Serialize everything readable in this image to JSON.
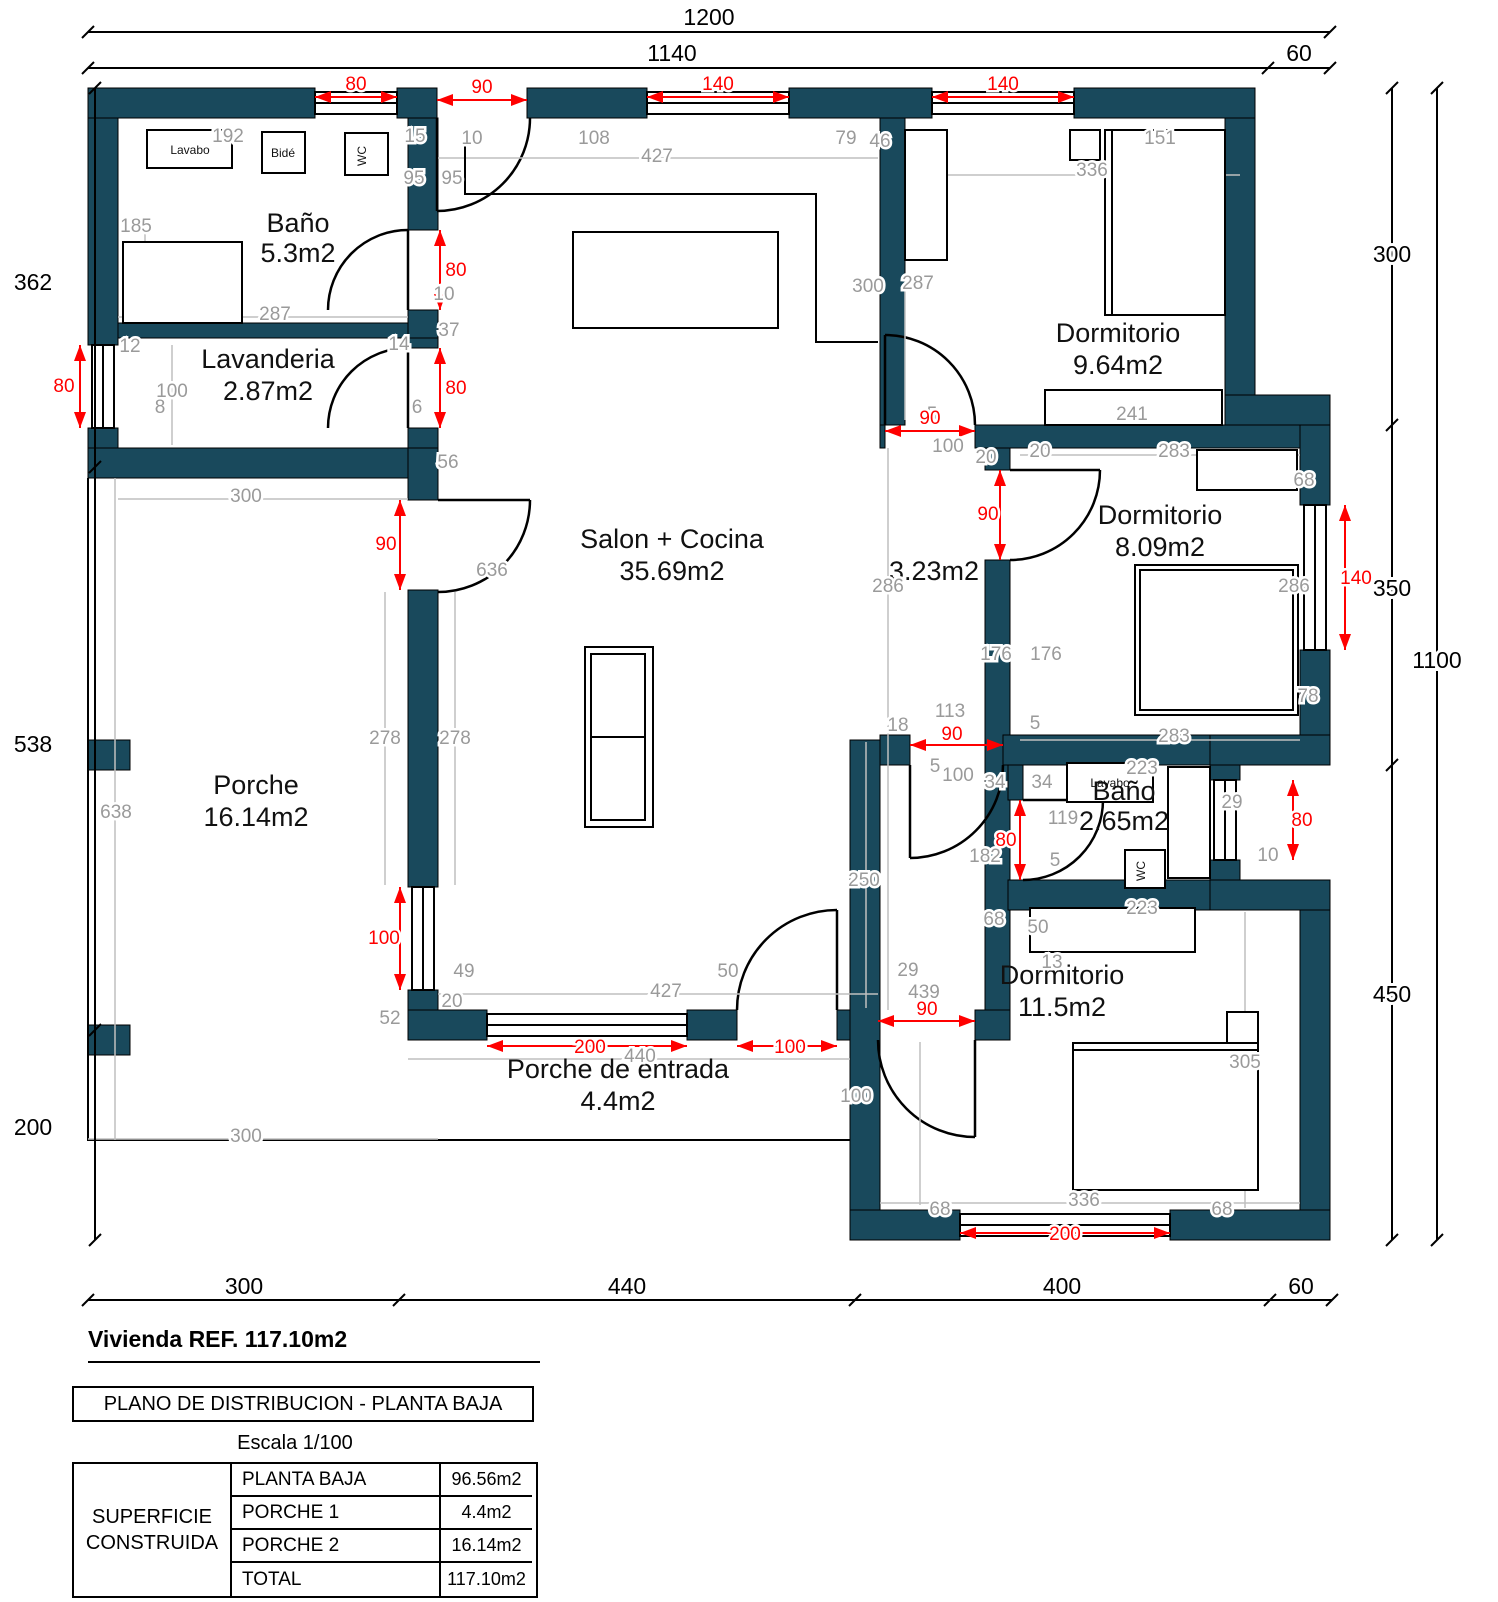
{
  "plan": {
    "colors": {
      "wall": "#19495c",
      "dim_red": "#ff0000",
      "dim_gray": "#9a9a9a",
      "line_gray": "#b5b5b5"
    },
    "room_labels": [
      {
        "n": "room-label-bano1",
        "t": "Baño",
        "x": 298,
        "y": 232
      },
      {
        "n": "room-area-bano1",
        "t": "5.3m2",
        "x": 298,
        "y": 262
      },
      {
        "n": "room-label-lavanderia",
        "t": "Lavanderia",
        "x": 268,
        "y": 368
      },
      {
        "n": "room-area-lavanderia",
        "t": "2.87m2",
        "x": 268,
        "y": 400
      },
      {
        "n": "room-label-salon",
        "t": "Salon + Cocina",
        "x": 672,
        "y": 548
      },
      {
        "n": "room-area-salon",
        "t": "35.69m2",
        "x": 672,
        "y": 580
      },
      {
        "n": "room-label-dormitorio1",
        "t": "Dormitorio",
        "x": 1118,
        "y": 342
      },
      {
        "n": "room-area-dormitorio1",
        "t": "9.64m2",
        "x": 1118,
        "y": 374
      },
      {
        "n": "room-area-pasillo",
        "t": "3.23m2",
        "x": 934,
        "y": 580
      },
      {
        "n": "room-label-dormitorio2",
        "t": "Dormitorio",
        "x": 1160,
        "y": 524
      },
      {
        "n": "room-area-dormitorio2",
        "t": "8.09m2",
        "x": 1160,
        "y": 556
      },
      {
        "n": "room-label-bano2",
        "t": "Baño",
        "x": 1124,
        "y": 800
      },
      {
        "n": "room-area-bano2",
        "t": "2.65m2",
        "x": 1124,
        "y": 830
      },
      {
        "n": "room-label-dormitorio3",
        "t": "Dormitorio",
        "x": 1062,
        "y": 984
      },
      {
        "n": "room-area-dormitorio3",
        "t": "11.5m2",
        "x": 1062,
        "y": 1016
      },
      {
        "n": "room-label-porche",
        "t": "Porche",
        "x": 256,
        "y": 794
      },
      {
        "n": "room-area-porche",
        "t": "16.14m2",
        "x": 256,
        "y": 826
      },
      {
        "n": "room-label-porche-entrada",
        "t": "Porche de entrada",
        "x": 618,
        "y": 1078
      },
      {
        "n": "room-area-porche-entrada",
        "t": "4.4m2",
        "x": 618,
        "y": 1110
      }
    ],
    "dims_black": [
      {
        "t": "1200",
        "x": 709,
        "y": 25
      },
      {
        "t": "1140",
        "x": 672,
        "y": 61
      },
      {
        "t": "60",
        "x": 1299,
        "y": 61
      },
      {
        "t": "300",
        "x": 1392,
        "y": 262
      },
      {
        "t": "350",
        "x": 1392,
        "y": 596
      },
      {
        "t": "450",
        "x": 1392,
        "y": 1002
      },
      {
        "t": "1100",
        "x": 1437,
        "y": 668
      },
      {
        "t": "362",
        "x": 33,
        "y": 290
      },
      {
        "t": "538",
        "x": 33,
        "y": 752
      },
      {
        "t": "200",
        "x": 33,
        "y": 1135
      },
      {
        "t": "300",
        "x": 244,
        "y": 1294
      },
      {
        "t": "440",
        "x": 627,
        "y": 1294
      },
      {
        "t": "400",
        "x": 1062,
        "y": 1294
      },
      {
        "t": "60",
        "x": 1301,
        "y": 1294
      }
    ],
    "dims_red": [
      {
        "t": "80",
        "x": 356,
        "y": 90
      },
      {
        "t": "90",
        "x": 482,
        "y": 93
      },
      {
        "t": "140",
        "x": 718,
        "y": 90
      },
      {
        "t": "140",
        "x": 1003,
        "y": 90
      },
      {
        "t": "80",
        "x": 456,
        "y": 276
      },
      {
        "t": "80",
        "x": 456,
        "y": 394
      },
      {
        "t": "80",
        "x": 64,
        "y": 392
      },
      {
        "t": "90",
        "x": 386,
        "y": 550
      },
      {
        "t": "90",
        "x": 930,
        "y": 424
      },
      {
        "t": "90",
        "x": 988,
        "y": 520
      },
      {
        "t": "140",
        "x": 1356,
        "y": 584
      },
      {
        "t": "90",
        "x": 952,
        "y": 740
      },
      {
        "t": "80",
        "x": 1006,
        "y": 846
      },
      {
        "t": "80",
        "x": 1302,
        "y": 826
      },
      {
        "t": "100",
        "x": 384,
        "y": 944
      },
      {
        "t": "200",
        "x": 590,
        "y": 1053
      },
      {
        "t": "100",
        "x": 790,
        "y": 1053
      },
      {
        "t": "90",
        "x": 927,
        "y": 1015
      },
      {
        "t": "200",
        "x": 1065,
        "y": 1240
      }
    ],
    "dims_gray": [
      {
        "t": "192",
        "x": 228,
        "y": 142
      },
      {
        "t": "15",
        "x": 415,
        "y": 142
      },
      {
        "t": "10",
        "x": 472,
        "y": 144
      },
      {
        "t": "95",
        "x": 414,
        "y": 184
      },
      {
        "t": "95",
        "x": 452,
        "y": 184
      },
      {
        "t": "185",
        "x": 136,
        "y": 232
      },
      {
        "t": "287",
        "x": 275,
        "y": 320
      },
      {
        "t": "10",
        "x": 444,
        "y": 300
      },
      {
        "t": "37",
        "x": 449,
        "y": 336
      },
      {
        "t": "12",
        "x": 130,
        "y": 352
      },
      {
        "t": "14",
        "x": 399,
        "y": 350
      },
      {
        "t": "100",
        "x": 172,
        "y": 397
      },
      {
        "t": "8",
        "x": 160,
        "y": 413
      },
      {
        "t": "6",
        "x": 417,
        "y": 413
      },
      {
        "t": "56",
        "x": 448,
        "y": 468
      },
      {
        "t": "108",
        "x": 594,
        "y": 144
      },
      {
        "t": "427",
        "x": 657,
        "y": 162
      },
      {
        "t": "79",
        "x": 846,
        "y": 144
      },
      {
        "t": "46",
        "x": 880,
        "y": 147
      },
      {
        "t": "151",
        "x": 1160,
        "y": 144
      },
      {
        "t": "336",
        "x": 1092,
        "y": 176
      },
      {
        "t": "300",
        "x": 868,
        "y": 292
      },
      {
        "t": "287",
        "x": 918,
        "y": 289
      },
      {
        "t": "241",
        "x": 1132,
        "y": 420
      },
      {
        "t": "5",
        "x": 932,
        "y": 420
      },
      {
        "t": "100",
        "x": 948,
        "y": 452
      },
      {
        "t": "20",
        "x": 986,
        "y": 463
      },
      {
        "t": "20",
        "x": 1040,
        "y": 457
      },
      {
        "t": "283",
        "x": 1174,
        "y": 457
      },
      {
        "t": "68",
        "x": 1304,
        "y": 486
      },
      {
        "t": "286",
        "x": 888,
        "y": 592
      },
      {
        "t": "286",
        "x": 1294,
        "y": 592
      },
      {
        "t": "176",
        "x": 996,
        "y": 660
      },
      {
        "t": "176",
        "x": 1046,
        "y": 660
      },
      {
        "t": "78",
        "x": 1308,
        "y": 702
      },
      {
        "t": "283",
        "x": 1174,
        "y": 742
      },
      {
        "t": "5",
        "x": 1035,
        "y": 729
      },
      {
        "t": "113",
        "x": 950,
        "y": 717
      },
      {
        "t": "18",
        "x": 898,
        "y": 731
      },
      {
        "t": "5",
        "x": 935,
        "y": 772
      },
      {
        "t": "100",
        "x": 958,
        "y": 781
      },
      {
        "t": "34",
        "x": 995,
        "y": 788
      },
      {
        "t": "34",
        "x": 1042,
        "y": 788
      },
      {
        "t": "223",
        "x": 1142,
        "y": 774
      },
      {
        "t": "119",
        "x": 1063,
        "y": 824
      },
      {
        "t": "182",
        "x": 985,
        "y": 862
      },
      {
        "t": "29",
        "x": 1232,
        "y": 808
      },
      {
        "t": "10",
        "x": 1268,
        "y": 861
      },
      {
        "t": "5",
        "x": 1055,
        "y": 866
      },
      {
        "t": "223",
        "x": 1142,
        "y": 914
      },
      {
        "t": "50",
        "x": 1038,
        "y": 933
      },
      {
        "t": "68",
        "x": 994,
        "y": 925
      },
      {
        "t": "13",
        "x": 1052,
        "y": 968
      },
      {
        "t": "250",
        "x": 864,
        "y": 886
      },
      {
        "t": "29",
        "x": 908,
        "y": 976
      },
      {
        "t": "439",
        "x": 924,
        "y": 998
      },
      {
        "t": "305",
        "x": 1245,
        "y": 1068
      },
      {
        "t": "336",
        "x": 1084,
        "y": 1206
      },
      {
        "t": "68",
        "x": 940,
        "y": 1215
      },
      {
        "t": "68",
        "x": 1222,
        "y": 1215
      },
      {
        "t": "300",
        "x": 246,
        "y": 502
      },
      {
        "t": "636",
        "x": 492,
        "y": 576
      },
      {
        "t": "278",
        "x": 385,
        "y": 744
      },
      {
        "t": "278",
        "x": 455,
        "y": 744
      },
      {
        "t": "638",
        "x": 116,
        "y": 818
      },
      {
        "t": "300",
        "x": 246,
        "y": 1142
      },
      {
        "t": "52",
        "x": 390,
        "y": 1024
      },
      {
        "t": "20",
        "x": 452,
        "y": 1007
      },
      {
        "t": "49",
        "x": 464,
        "y": 977
      },
      {
        "t": "427",
        "x": 666,
        "y": 997
      },
      {
        "t": "50",
        "x": 728,
        "y": 977
      },
      {
        "t": "440",
        "x": 640,
        "y": 1062
      },
      {
        "t": "100",
        "x": 856,
        "y": 1102
      }
    ],
    "fixtures": [
      {
        "n": "lavabo-bano1-label",
        "t": "Lavabo",
        "x": 190,
        "y": 154,
        "r": 0
      },
      {
        "n": "bide-bano1-label",
        "t": "Bidé",
        "x": 283,
        "y": 157,
        "r": 0
      },
      {
        "n": "wc-bano1-label",
        "t": "WC",
        "x": 366,
        "y": 156,
        "r": -90
      },
      {
        "n": "lavabo-bano2-label",
        "t": "Lavabo",
        "x": 1110,
        "y": 787,
        "r": 0
      },
      {
        "n": "wc-bano2-label",
        "t": "WC",
        "x": 1145,
        "y": 871,
        "r": -90
      }
    ]
  },
  "footer": {
    "title": "Vivienda REF. 117.10m2",
    "plan_box": "PLANO DE DISTRIBUCION - PLANTA BAJA",
    "scale": "Escala 1/100",
    "table_header": "SUPERFICIE CONSTRUIDA",
    "rows": [
      {
        "label": "PLANTA BAJA",
        "value": "96.56m2"
      },
      {
        "label": "PORCHE 1",
        "value": "4.4m2"
      },
      {
        "label": "PORCHE 2",
        "value": "16.14m2"
      },
      {
        "label": "TOTAL",
        "value": "117.10m2"
      }
    ]
  }
}
